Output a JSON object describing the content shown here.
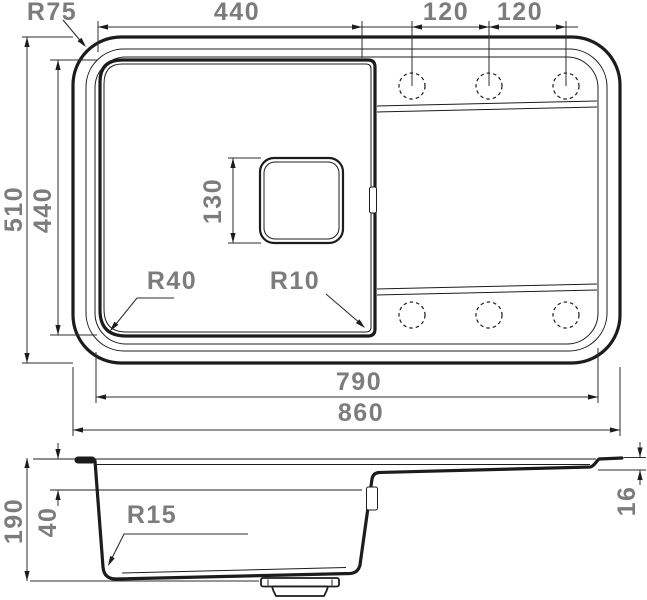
{
  "drawing_title": "sink-dimensional-drawing",
  "top_view": {
    "corner_radius": "R75",
    "bowl_width": "440",
    "hole_spacing_left": "120",
    "hole_spacing_right": "120",
    "total_depth": "510",
    "bowl_depth": "440",
    "drain_size": "130",
    "radius_bottom_left": "R40",
    "radius_bottom_right": "R10",
    "inner_width": "790",
    "total_width": "860"
  },
  "side_view": {
    "total_height": "190",
    "rim_depth": "40",
    "bottom_radius": "R15",
    "edge_thickness": "16"
  },
  "colors": {
    "line_color": "#1c1c1c",
    "dimension_text_color": "#7c7c7c",
    "background": "#ffffff"
  }
}
